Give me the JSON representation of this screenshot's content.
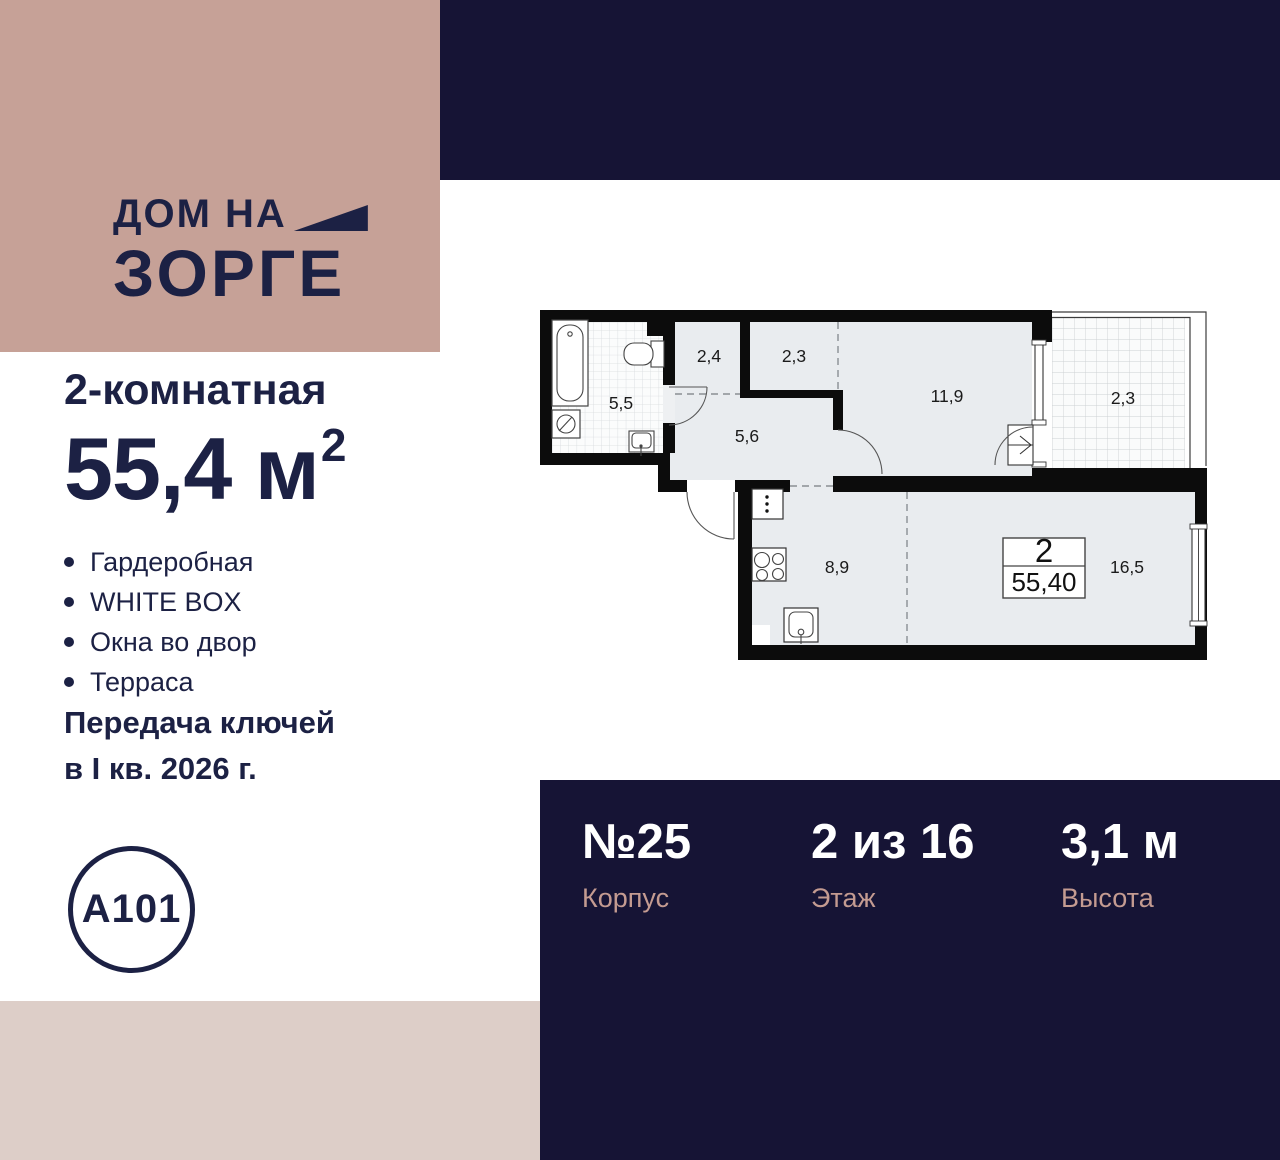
{
  "brand": {
    "line1": "ДОМ НА",
    "line2": "ЗОРГЕ"
  },
  "listing": {
    "type_label": "2-комнатная",
    "area_value": "55,4 м",
    "area_sup": "2"
  },
  "features": [
    "Гардеробная",
    "WHITE BOX",
    "Окна во двор",
    "Терраса"
  ],
  "handover": {
    "line1": "Передача ключей",
    "line2": "в I кв. 2026 г."
  },
  "developer_logo": "A101",
  "plan": {
    "bathroom": "5,5",
    "wardrobe": "2,4",
    "closet": "2,3",
    "bedroom": "11,9",
    "terrace": "2,3",
    "hall": "5,6",
    "kitchen": "8,9",
    "living": "16,5",
    "rooms_count": "2",
    "total_area": "55,40"
  },
  "stats": [
    {
      "value": "№25",
      "label": "Корпус"
    },
    {
      "value": "2 из 16",
      "label": "Этаж"
    },
    {
      "value": "3,1 м",
      "label": "Высота"
    }
  ],
  "colors": {
    "brand_pink": "#c6a197",
    "strip_pink": "#ddcec8",
    "navy": "#161435",
    "text_navy": "#1c2144",
    "stat_label_pink": "#c49b91"
  }
}
